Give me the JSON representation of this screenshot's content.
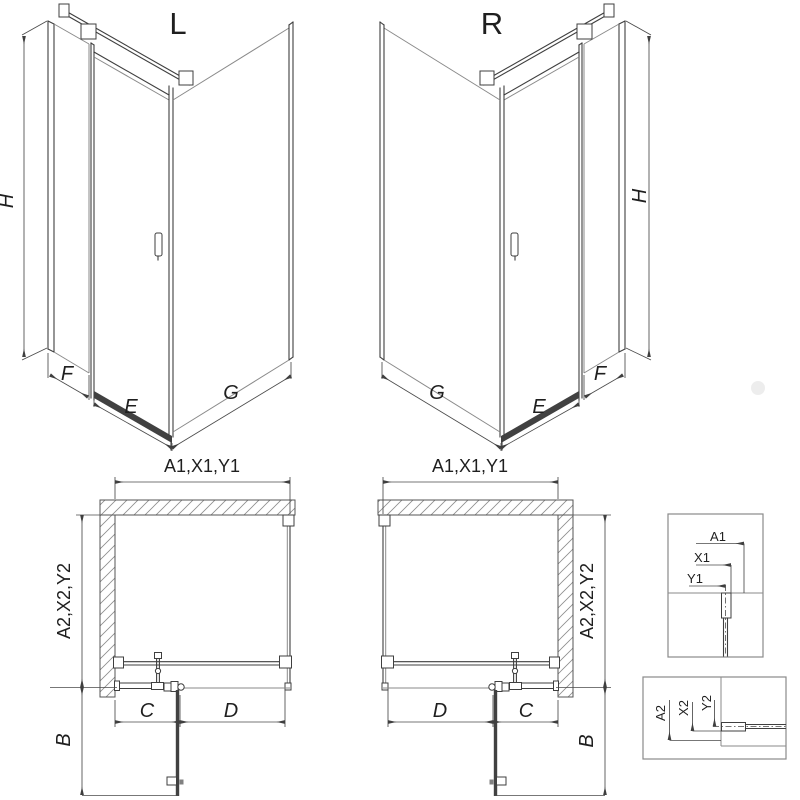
{
  "figure": {
    "background": "#ffffff",
    "line_color": "#3f3f3f",
    "iso_left": {
      "title": "L",
      "height": "H",
      "front_fixed": "F",
      "door": "E",
      "side": "G"
    },
    "iso_right": {
      "title": "R",
      "height": "H",
      "front_fixed": "F",
      "door": "E",
      "side": "G"
    },
    "plan_left": {
      "width_top": "A1,X1,Y1",
      "depth_side": "A2,X2,Y2",
      "fixed": "C",
      "door": "D",
      "swing": "B"
    },
    "plan_right": {
      "width_top": "A1,X1,Y1",
      "depth_side": "A2,X2,Y2",
      "fixed": "C",
      "door": "D",
      "swing": "B"
    },
    "detail_width": {
      "labels": [
        "A1",
        "X1",
        "Y1"
      ]
    },
    "detail_depth": {
      "labels": [
        "A2",
        "X2",
        "Y2"
      ]
    }
  }
}
